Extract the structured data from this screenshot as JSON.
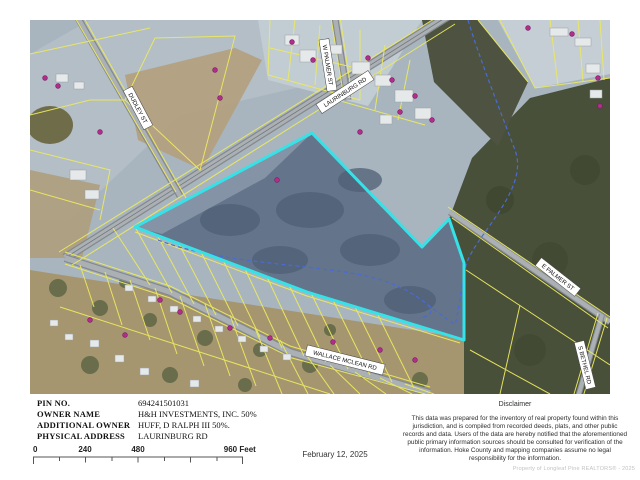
{
  "map": {
    "roads": {
      "laurinburg": "LAURINBURG RD",
      "w_palmer": "W PALMER ST",
      "dudley": "DUDLEY ST",
      "wallace_mclean": "WALLACE MCLEAN RD",
      "e_palmer": "E PALMER ST",
      "s_bethel": "S BETHEL RD"
    },
    "colors": {
      "subject_parcel_outline": "#35e2e8",
      "parcel_lines": "#ece95f",
      "stream": "#4a6bd4",
      "address_marker": "#b02d8c",
      "road_fill": "#aab0b4",
      "forest": "#49503a",
      "field": "#a8b5bf"
    }
  },
  "info": {
    "rows": [
      {
        "label": "PIN NO.",
        "value": "694241501031"
      },
      {
        "label": "OWNER NAME",
        "value": "H&H INVESTMENTS, INC. 50%"
      },
      {
        "label": "ADDITIONAL OWNER",
        "value": "HUFF, D RALPH III 50%."
      },
      {
        "label": "PHYSICAL ADDRESS",
        "value": "LAURINBURG RD"
      }
    ]
  },
  "scale": {
    "ticks": [
      "0",
      "240",
      "480"
    ],
    "end": "960 Feet"
  },
  "date": "February 12, 2025",
  "disclaimer": {
    "title": "Disclaimer",
    "body": "This data was prepared for the inventory of real property found within this jurisdiction, and is compiled from recorded deeds, plats, and other public records and data. Users of the data are hereby notified that the aforementioned public primary information sources should be consulted for verification of the information. Hoke County and mapping companies assume no legal responsibility for the information."
  },
  "watermark": "Property of Longleaf Pine REALTORS® - 2025"
}
